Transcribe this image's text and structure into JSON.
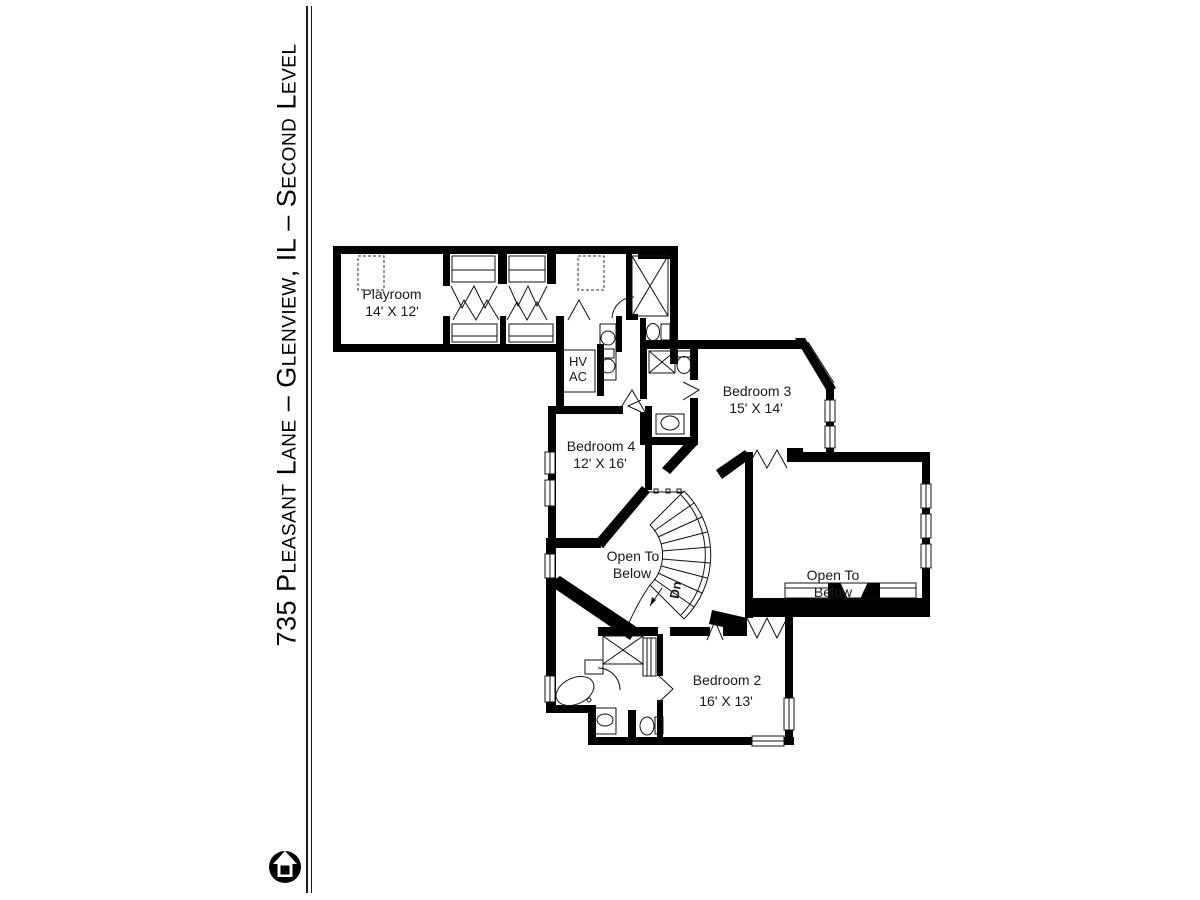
{
  "page": {
    "background": "#ffffff",
    "line_color": "#000000"
  },
  "sidebar": {
    "title": "735 Pleasant Lane – Glenview, IL – Second Level",
    "compass_letter": "N"
  },
  "floorplan": {
    "rooms": {
      "playroom": {
        "name": "Playroom",
        "dims": "14' X 12'"
      },
      "bedroom4": {
        "name": "Bedroom 4",
        "dims": "12' X 16'"
      },
      "bedroom3": {
        "name": "Bedroom 3",
        "dims": "15' X 14'"
      },
      "bedroom2": {
        "name": "Bedroom 2",
        "dims": "16' X 13'"
      },
      "open_left": {
        "line1": "Open To",
        "line2": "Below"
      },
      "open_right": {
        "line1": "Open To",
        "line2": "Below"
      },
      "hvac": {
        "line1": "HV",
        "line2": "AC"
      },
      "stairs": {
        "label": "Dn"
      }
    }
  }
}
